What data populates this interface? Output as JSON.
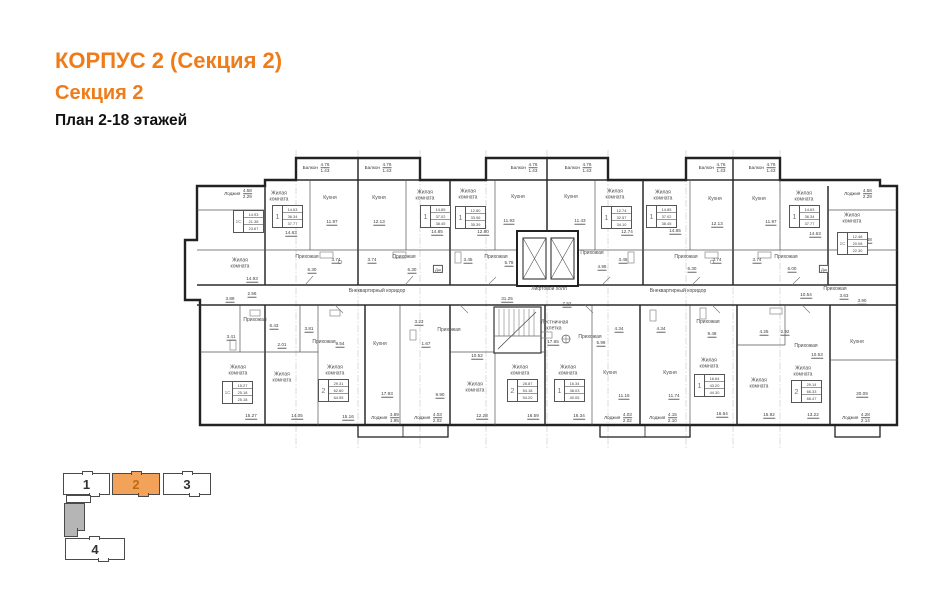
{
  "header": {
    "title": "КОРПУС 2 (Секция 2)",
    "subtitle": "Секция 2",
    "plan_line": "План 2-18 этажей"
  },
  "colors": {
    "accent_orange": "#ef7c1a",
    "legend_active_fill": "#f2a359",
    "legend_active_number": "#c06a15",
    "wall": "#222222"
  },
  "plan": {
    "room_labels": [
      {
        "t": "Жилая комната",
        "x": 279,
        "y": 197,
        "w": 30
      },
      {
        "t": "Кухня",
        "x": 330,
        "y": 199
      },
      {
        "t": "Кухня",
        "x": 379,
        "y": 199
      },
      {
        "t": "Жилая комната",
        "x": 425,
        "y": 196,
        "w": 30
      },
      {
        "t": "Жилая комната",
        "x": 468,
        "y": 195,
        "w": 30
      },
      {
        "t": "Кухня",
        "x": 518,
        "y": 198
      },
      {
        "t": "Кухня",
        "x": 571,
        "y": 198
      },
      {
        "t": "Жилая комната",
        "x": 615,
        "y": 195,
        "w": 30
      },
      {
        "t": "Жилая комната",
        "x": 663,
        "y": 196,
        "w": 30
      },
      {
        "t": "Кухня",
        "x": 715,
        "y": 200
      },
      {
        "t": "Кухня",
        "x": 759,
        "y": 200
      },
      {
        "t": "Жилая комната",
        "x": 804,
        "y": 197,
        "w": 30
      },
      {
        "t": "Жилая комната",
        "x": 852,
        "y": 219,
        "w": 30
      },
      {
        "t": "Жилая комната",
        "x": 240,
        "y": 264,
        "w": 30
      },
      {
        "t": "Прихожая",
        "x": 307,
        "y": 258
      },
      {
        "t": "Прихожая",
        "x": 404,
        "y": 258
      },
      {
        "t": "Прихожая",
        "x": 496,
        "y": 258
      },
      {
        "t": "Прихожая",
        "x": 592,
        "y": 254
      },
      {
        "t": "Прихожая",
        "x": 686,
        "y": 258
      },
      {
        "t": "Прихожая",
        "x": 786,
        "y": 258
      },
      {
        "t": "Внеквартирный коридор",
        "x": 377,
        "y": 292
      },
      {
        "t": "Внеквартирный коридор",
        "x": 678,
        "y": 292
      },
      {
        "t": "Лифтовой холл",
        "x": 549,
        "y": 290
      },
      {
        "t": "Лестничная клетка",
        "x": 554,
        "y": 326,
        "w": 26
      },
      {
        "t": "Прихожая",
        "x": 590,
        "y": 338
      },
      {
        "t": "Прихожая",
        "x": 255,
        "y": 321
      },
      {
        "t": "Прихожая",
        "x": 324,
        "y": 343
      },
      {
        "t": "Прихожая",
        "x": 449,
        "y": 331
      },
      {
        "t": "Кухня",
        "x": 380,
        "y": 345
      },
      {
        "t": "Жилая комната",
        "x": 238,
        "y": 371,
        "w": 30
      },
      {
        "t": "Жилая комната",
        "x": 282,
        "y": 378,
        "w": 30
      },
      {
        "t": "Жилая комната",
        "x": 335,
        "y": 371,
        "w": 30
      },
      {
        "t": "Жилая комната",
        "x": 475,
        "y": 388,
        "w": 30
      },
      {
        "t": "Жилая комната",
        "x": 520,
        "y": 371,
        "w": 30
      },
      {
        "t": "Жилая комната",
        "x": 568,
        "y": 371,
        "w": 30
      },
      {
        "t": "Кухня",
        "x": 610,
        "y": 374
      },
      {
        "t": "Кухня",
        "x": 670,
        "y": 374
      },
      {
        "t": "Прихожая",
        "x": 708,
        "y": 323
      },
      {
        "t": "Прихожая",
        "x": 806,
        "y": 347
      },
      {
        "t": "Кухня",
        "x": 857,
        "y": 343
      },
      {
        "t": "Жилая комната",
        "x": 709,
        "y": 364,
        "w": 30
      },
      {
        "t": "Жилая комната",
        "x": 759,
        "y": 384,
        "w": 30
      },
      {
        "t": "Жилая комната",
        "x": 803,
        "y": 372,
        "w": 30
      },
      {
        "t": "Прихожая",
        "x": 835,
        "y": 290
      }
    ],
    "dim_labels": [
      {
        "t": "14.63",
        "x": 291,
        "y": 233
      },
      {
        "t": "11.97",
        "x": 332,
        "y": 222
      },
      {
        "t": "12.13",
        "x": 379,
        "y": 222
      },
      {
        "t": "14.85",
        "x": 437,
        "y": 232
      },
      {
        "t": "12.80",
        "x": 483,
        "y": 232
      },
      {
        "t": "11.93",
        "x": 509,
        "y": 221
      },
      {
        "t": "11.43",
        "x": 580,
        "y": 221
      },
      {
        "t": "12.74",
        "x": 627,
        "y": 232
      },
      {
        "t": "14.85",
        "x": 675,
        "y": 231
      },
      {
        "t": "12.13",
        "x": 717,
        "y": 224
      },
      {
        "t": "11.97",
        "x": 771,
        "y": 222
      },
      {
        "t": "14.63",
        "x": 815,
        "y": 234
      },
      {
        "t": "12.48",
        "x": 866,
        "y": 240
      },
      {
        "t": "14.93",
        "x": 252,
        "y": 279
      },
      {
        "t": "6.30",
        "x": 312,
        "y": 270
      },
      {
        "t": "3.74",
        "x": 336,
        "y": 260
      },
      {
        "t": "3.74",
        "x": 372,
        "y": 260
      },
      {
        "t": "6.30",
        "x": 412,
        "y": 270
      },
      {
        "t": "3.45",
        "x": 468,
        "y": 260
      },
      {
        "t": "5.78",
        "x": 509,
        "y": 263
      },
      {
        "t": "4.95",
        "x": 602,
        "y": 267
      },
      {
        "t": "3.45",
        "x": 623,
        "y": 260
      },
      {
        "t": "6.30",
        "x": 692,
        "y": 269
      },
      {
        "t": "3.74",
        "x": 717,
        "y": 260
      },
      {
        "t": "3.74",
        "x": 757,
        "y": 260
      },
      {
        "t": "6.00",
        "x": 792,
        "y": 269
      },
      {
        "t": "31.25",
        "x": 507,
        "y": 299
      },
      {
        "t": "7.52",
        "x": 567,
        "y": 304
      },
      {
        "t": "17.65",
        "x": 553,
        "y": 342
      },
      {
        "t": "5.99",
        "x": 601,
        "y": 343
      },
      {
        "t": "3.89",
        "x": 230,
        "y": 299
      },
      {
        "t": "2.56",
        "x": 252,
        "y": 294
      },
      {
        "t": "6.43",
        "x": 274,
        "y": 326
      },
      {
        "t": "3.41",
        "x": 231,
        "y": 337
      },
      {
        "t": "2.01",
        "x": 282,
        "y": 345
      },
      {
        "t": "3.81",
        "x": 309,
        "y": 329
      },
      {
        "t": "9.54",
        "x": 340,
        "y": 344
      },
      {
        "t": "3.23",
        "x": 419,
        "y": 322
      },
      {
        "t": "1.67",
        "x": 426,
        "y": 344
      },
      {
        "t": "10.52",
        "x": 477,
        "y": 356
      },
      {
        "t": "9.90",
        "x": 440,
        "y": 395
      },
      {
        "t": "17.93",
        "x": 387,
        "y": 394
      },
      {
        "t": "4.34",
        "x": 619,
        "y": 329
      },
      {
        "t": "4.34",
        "x": 661,
        "y": 329
      },
      {
        "t": "11.16",
        "x": 624,
        "y": 396
      },
      {
        "t": "11.74",
        "x": 674,
        "y": 396
      },
      {
        "t": "9.48",
        "x": 712,
        "y": 334
      },
      {
        "t": "4.25",
        "x": 764,
        "y": 332
      },
      {
        "t": "2.92",
        "x": 785,
        "y": 332
      },
      {
        "t": "10.53",
        "x": 817,
        "y": 355
      },
      {
        "t": "10.54",
        "x": 806,
        "y": 295
      },
      {
        "t": "3.63",
        "x": 844,
        "y": 296
      },
      {
        "t": "3.90",
        "x": 862,
        "y": 301
      },
      {
        "t": "20.09",
        "x": 862,
        "y": 394
      },
      {
        "t": "15.27",
        "x": 251,
        "y": 416
      },
      {
        "t": "14.05",
        "x": 297,
        "y": 416
      },
      {
        "t": "15.16",
        "x": 348,
        "y": 417
      },
      {
        "t": "12.28",
        "x": 482,
        "y": 416
      },
      {
        "t": "16.59",
        "x": 533,
        "y": 416
      },
      {
        "t": "16.34",
        "x": 579,
        "y": 416
      },
      {
        "t": "16.64",
        "x": 722,
        "y": 414
      },
      {
        "t": "15.92",
        "x": 769,
        "y": 415
      },
      {
        "t": "13.22",
        "x": 813,
        "y": 415
      }
    ],
    "frac_labels": [
      {
        "n": "Балкон",
        "a": "4.76",
        "b": "1.43",
        "x": 316,
        "y": 168
      },
      {
        "n": "Балкон",
        "a": "4.76",
        "b": "1.43",
        "x": 378,
        "y": 168
      },
      {
        "n": "Балкон",
        "a": "4.76",
        "b": "1.43",
        "x": 524,
        "y": 168
      },
      {
        "n": "Балкон",
        "a": "4.76",
        "b": "1.43",
        "x": 578,
        "y": 168
      },
      {
        "n": "Балкон",
        "a": "4.76",
        "b": "1.43",
        "x": 712,
        "y": 168
      },
      {
        "n": "Балкон",
        "a": "4.76",
        "b": "1.43",
        "x": 762,
        "y": 168
      },
      {
        "n": "Лоджия",
        "a": "4.58",
        "b": "2.29",
        "x": 238,
        "y": 194
      },
      {
        "n": "Лоджия",
        "a": "4.58",
        "b": "2.29",
        "x": 858,
        "y": 194
      },
      {
        "n": "Лоджия",
        "a": "3.89",
        "b": "1.95",
        "x": 385,
        "y": 418
      },
      {
        "n": "Лоджия",
        "a": "4.03",
        "b": "2.02",
        "x": 428,
        "y": 418
      },
      {
        "n": "Лоджия",
        "a": "4.03",
        "b": "2.02",
        "x": 618,
        "y": 418
      },
      {
        "n": "Лоджия",
        "a": "4.15",
        "b": "2.10",
        "x": 663,
        "y": 418
      },
      {
        "n": "Лоджия",
        "a": "4.28",
        "b": "2.14",
        "x": 856,
        "y": 418
      }
    ],
    "apt_tables": [
      {
        "type": "1С",
        "rows": [
          "14.93",
          "21.38",
          "23.67"
        ],
        "x": 233,
        "y": 210
      },
      {
        "type": "1",
        "rows": [
          "14.63",
          "36.34",
          "37.77"
        ],
        "x": 272,
        "y": 205
      },
      {
        "type": "1",
        "rows": [
          "14.85",
          "37.02",
          "38.45"
        ],
        "x": 420,
        "y": 205
      },
      {
        "type": "1",
        "rows": [
          "12.80",
          "33.96",
          "35.39"
        ],
        "x": 455,
        "y": 206
      },
      {
        "type": "1",
        "rows": [
          "12.74",
          "32.57",
          "34.10"
        ],
        "x": 601,
        "y": 206
      },
      {
        "type": "1",
        "rows": [
          "14.85",
          "37.02",
          "38.45"
        ],
        "x": 646,
        "y": 205
      },
      {
        "type": "1",
        "rows": [
          "14.63",
          "36.34",
          "37.77"
        ],
        "x": 789,
        "y": 205
      },
      {
        "type": "1С",
        "rows": [
          "12.48",
          "20.08",
          "22.30"
        ],
        "x": 837,
        "y": 232
      },
      {
        "type": "1С",
        "rows": [
          "15.27",
          "25.18",
          "25.18"
        ],
        "x": 222,
        "y": 381
      },
      {
        "type": "2",
        "rows": [
          "29.31",
          "62.60",
          "64.55"
        ],
        "x": 318,
        "y": 379
      },
      {
        "type": "2",
        "rows": [
          "28.87",
          "54.18",
          "54.20"
        ],
        "x": 507,
        "y": 379
      },
      {
        "type": "1",
        "rows": [
          "16.34",
          "38.03",
          "40.05"
        ],
        "x": 554,
        "y": 379
      },
      {
        "type": "1",
        "rows": [
          "16.64",
          "43.20",
          "44.30"
        ],
        "x": 694,
        "y": 374
      },
      {
        "type": "2",
        "rows": [
          "29.14",
          "66.33",
          "68.47"
        ],
        "x": 791,
        "y": 380
      }
    ],
    "box_labels": [
      {
        "t": "Дш",
        "x": 438,
        "y": 269
      },
      {
        "t": "Дш",
        "x": 824,
        "y": 269
      }
    ]
  },
  "legend": {
    "sections": [
      {
        "label": "1",
        "active": false
      },
      {
        "label": "2",
        "active": true
      },
      {
        "label": "3",
        "active": false
      },
      {
        "label": "4",
        "active": false
      }
    ]
  }
}
